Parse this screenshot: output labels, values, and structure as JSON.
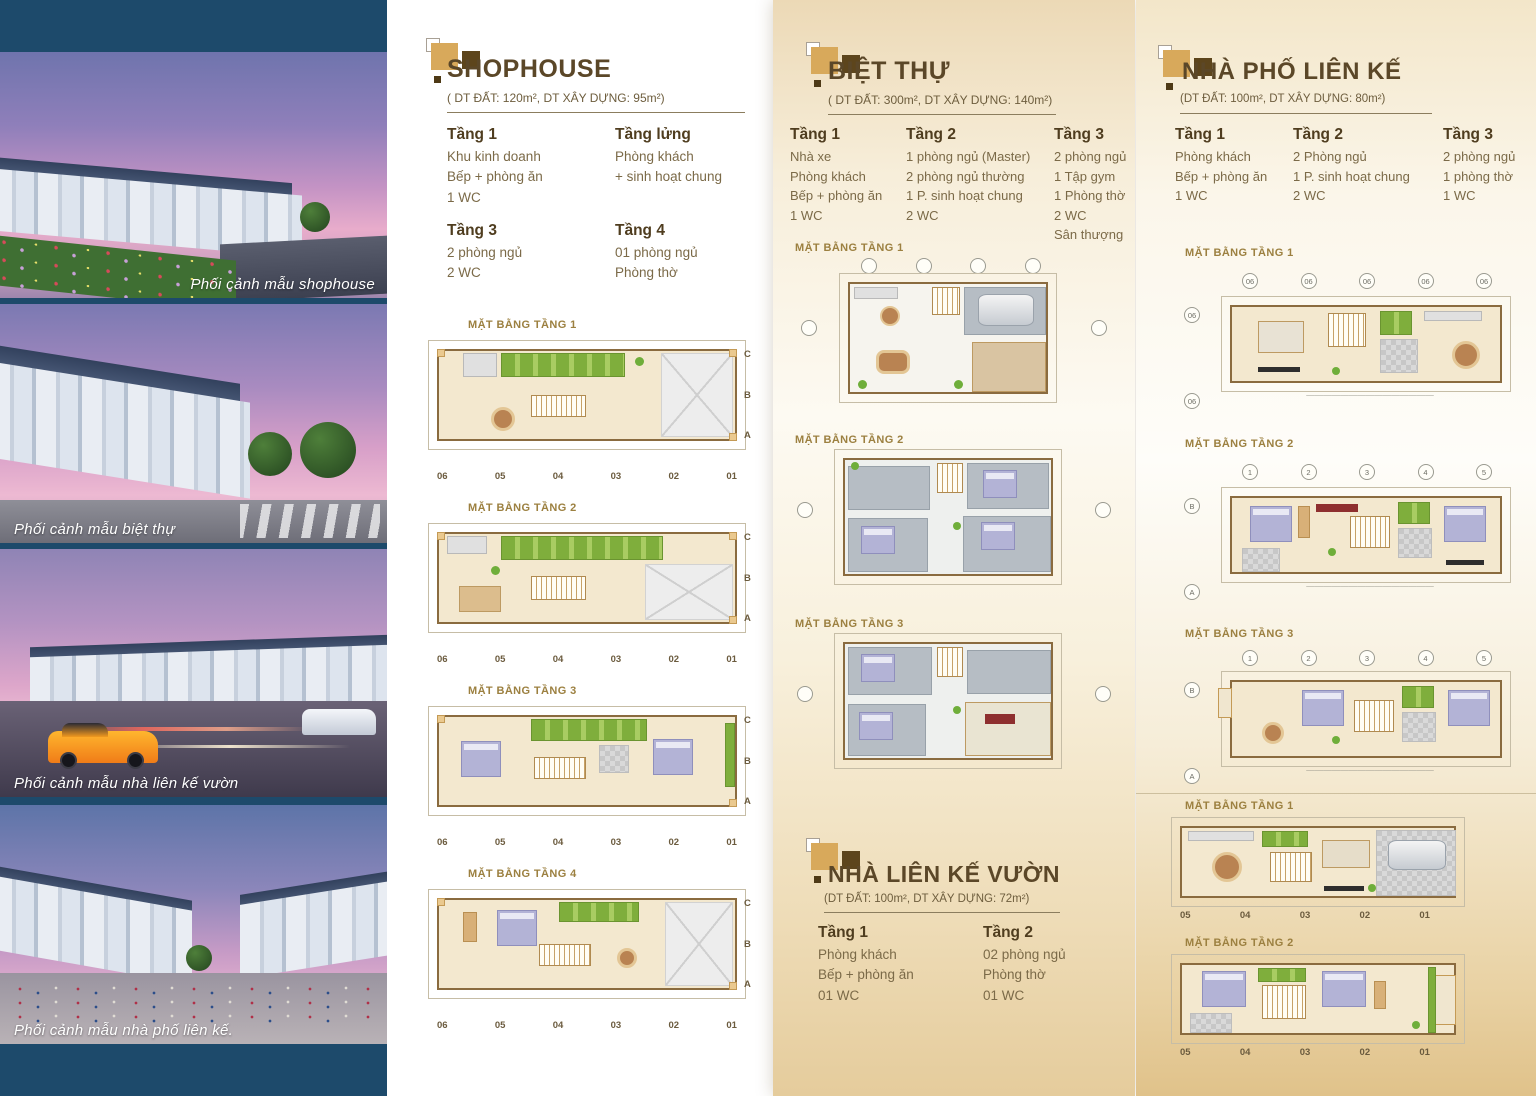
{
  "brand": {
    "navy": "#1d4a6b",
    "gold": "#d8a95b",
    "dark_brown": "#5d451c",
    "title_brown": "#5b4728",
    "body_brown": "#7b6a48",
    "plan_label_gold": "#9c8040"
  },
  "photo_panel": {
    "captions": [
      "Phối cảnh mẫu shophouse",
      "Phối cảnh mẫu biệt thự",
      "Phối cảnh mẫu nhà liên kế vườn",
      "Phối cảnh mẫu nhà phố liên kế."
    ]
  },
  "sections": {
    "shophouse": {
      "title": "SHOPHOUSE",
      "subtitle": "( DT ĐẤT: 120m², DT XÂY DỰNG: 95m²)",
      "floors": [
        {
          "title": "Tầng 1",
          "items": [
            "Khu kinh doanh",
            "Bếp + phòng ăn",
            "1 WC"
          ]
        },
        {
          "title": "Tầng lửng",
          "items": [
            "Phòng khách",
            "+ sinh hoạt chung"
          ]
        },
        {
          "title": "Tầng 3",
          "items": [
            "2 phòng ngủ",
            "2 WC"
          ]
        },
        {
          "title": "Tầng 4",
          "items": [
            "01 phòng ngủ",
            "Phòng thờ"
          ]
        }
      ],
      "plans": [
        {
          "label": "MẶT BẰNG TẦNG 1",
          "grid_bottom": [
            "06",
            "05",
            "04",
            "03",
            "02",
            "01"
          ],
          "grid_right": [
            "C",
            "B",
            "A"
          ]
        },
        {
          "label": "MẶT BẰNG TẦNG 2",
          "grid_bottom": [
            "06",
            "05",
            "04",
            "03",
            "02",
            "01"
          ],
          "grid_right": [
            "C",
            "B",
            "A"
          ]
        },
        {
          "label": "MẶT BẰNG TẦNG 3",
          "grid_bottom": [
            "06",
            "05",
            "04",
            "03",
            "02",
            "01"
          ],
          "grid_right": [
            "C",
            "B",
            "A"
          ]
        },
        {
          "label": "MẶT BẰNG TẦNG 4",
          "grid_bottom": [
            "06",
            "05",
            "04",
            "03",
            "02",
            "01"
          ],
          "grid_right": [
            "C",
            "B",
            "A"
          ]
        }
      ]
    },
    "bietthu": {
      "title": "BIỆT THỰ",
      "subtitle": "( DT ĐẤT: 300m², DT XÂY DỰNG: 140m²)",
      "floors": [
        {
          "title": "Tầng 1",
          "items": [
            "Nhà xe",
            "Phòng khách",
            "Bếp + phòng ăn",
            "1 WC"
          ]
        },
        {
          "title": "Tầng 2",
          "items": [
            "1 phòng ngủ (Master)",
            "2 phòng ngủ thường",
            "1 P. sinh hoạt chung",
            "2 WC"
          ]
        },
        {
          "title": "Tầng 3",
          "items": [
            "2 phòng ngủ",
            "1 Tập gym",
            "1 Phòng thờ",
            "2 WC",
            "Sân thượng"
          ]
        }
      ],
      "plans": [
        {
          "label": "MẶT BẰNG TẦNG 1"
        },
        {
          "label": "MẶT BẰNG TẦNG 2"
        },
        {
          "label": "MẶT BẰNG TẦNG 3"
        }
      ]
    },
    "nhapho": {
      "title": "NHÀ PHỐ LIÊN KẾ",
      "subtitle": "(DT ĐẤT: 100m², DT XÂY DỰNG: 80m²)",
      "floors": [
        {
          "title": "Tầng 1",
          "items": [
            "Phòng khách",
            "Bếp + phòng ăn",
            "1 WC"
          ]
        },
        {
          "title": "Tầng 2",
          "items": [
            "2 Phòng ngủ",
            "1 P. sinh hoạt chung",
            "2 WC"
          ]
        },
        {
          "title": "Tầng 3",
          "items": [
            "2 phòng ngủ",
            "1 phòng thờ",
            "1 WC"
          ]
        }
      ],
      "plans": [
        {
          "label": "MẶT BẰNG TẦNG 1",
          "grid_top": [
            "06",
            "06",
            "06",
            "06",
            "06"
          ],
          "grid_left": [
            "06",
            "06"
          ]
        },
        {
          "label": "MẶT BẰNG TẦNG 2",
          "grid_top": [
            "1",
            "2",
            "3",
            "4",
            "5"
          ],
          "grid_left": [
            "B",
            "A"
          ]
        },
        {
          "label": "MẶT BẰNG TẦNG 3",
          "grid_top": [
            "1",
            "2",
            "3",
            "4",
            "5"
          ],
          "grid_left": [
            "B",
            "A"
          ]
        }
      ]
    },
    "lienkevuon": {
      "title": "NHÀ LIÊN KẾ VƯỜN",
      "subtitle": "(DT ĐẤT: 100m², DT XÂY DỰNG: 72m²)",
      "floors": [
        {
          "title": "Tầng 1",
          "items": [
            "Phòng khách",
            "Bếp + phòng ăn",
            "01 WC"
          ]
        },
        {
          "title": "Tầng 2",
          "items": [
            "02 phòng ngủ",
            "Phòng thờ",
            "01 WC"
          ]
        }
      ],
      "plans": [
        {
          "label": "MẶT BẰNG TẦNG 1",
          "grid_bottom": [
            "05",
            "04",
            "03",
            "02",
            "01"
          ]
        },
        {
          "label": "MẶT BẰNG TẦNG 2",
          "grid_bottom": [
            "05",
            "04",
            "03",
            "02",
            "01"
          ]
        }
      ]
    }
  }
}
